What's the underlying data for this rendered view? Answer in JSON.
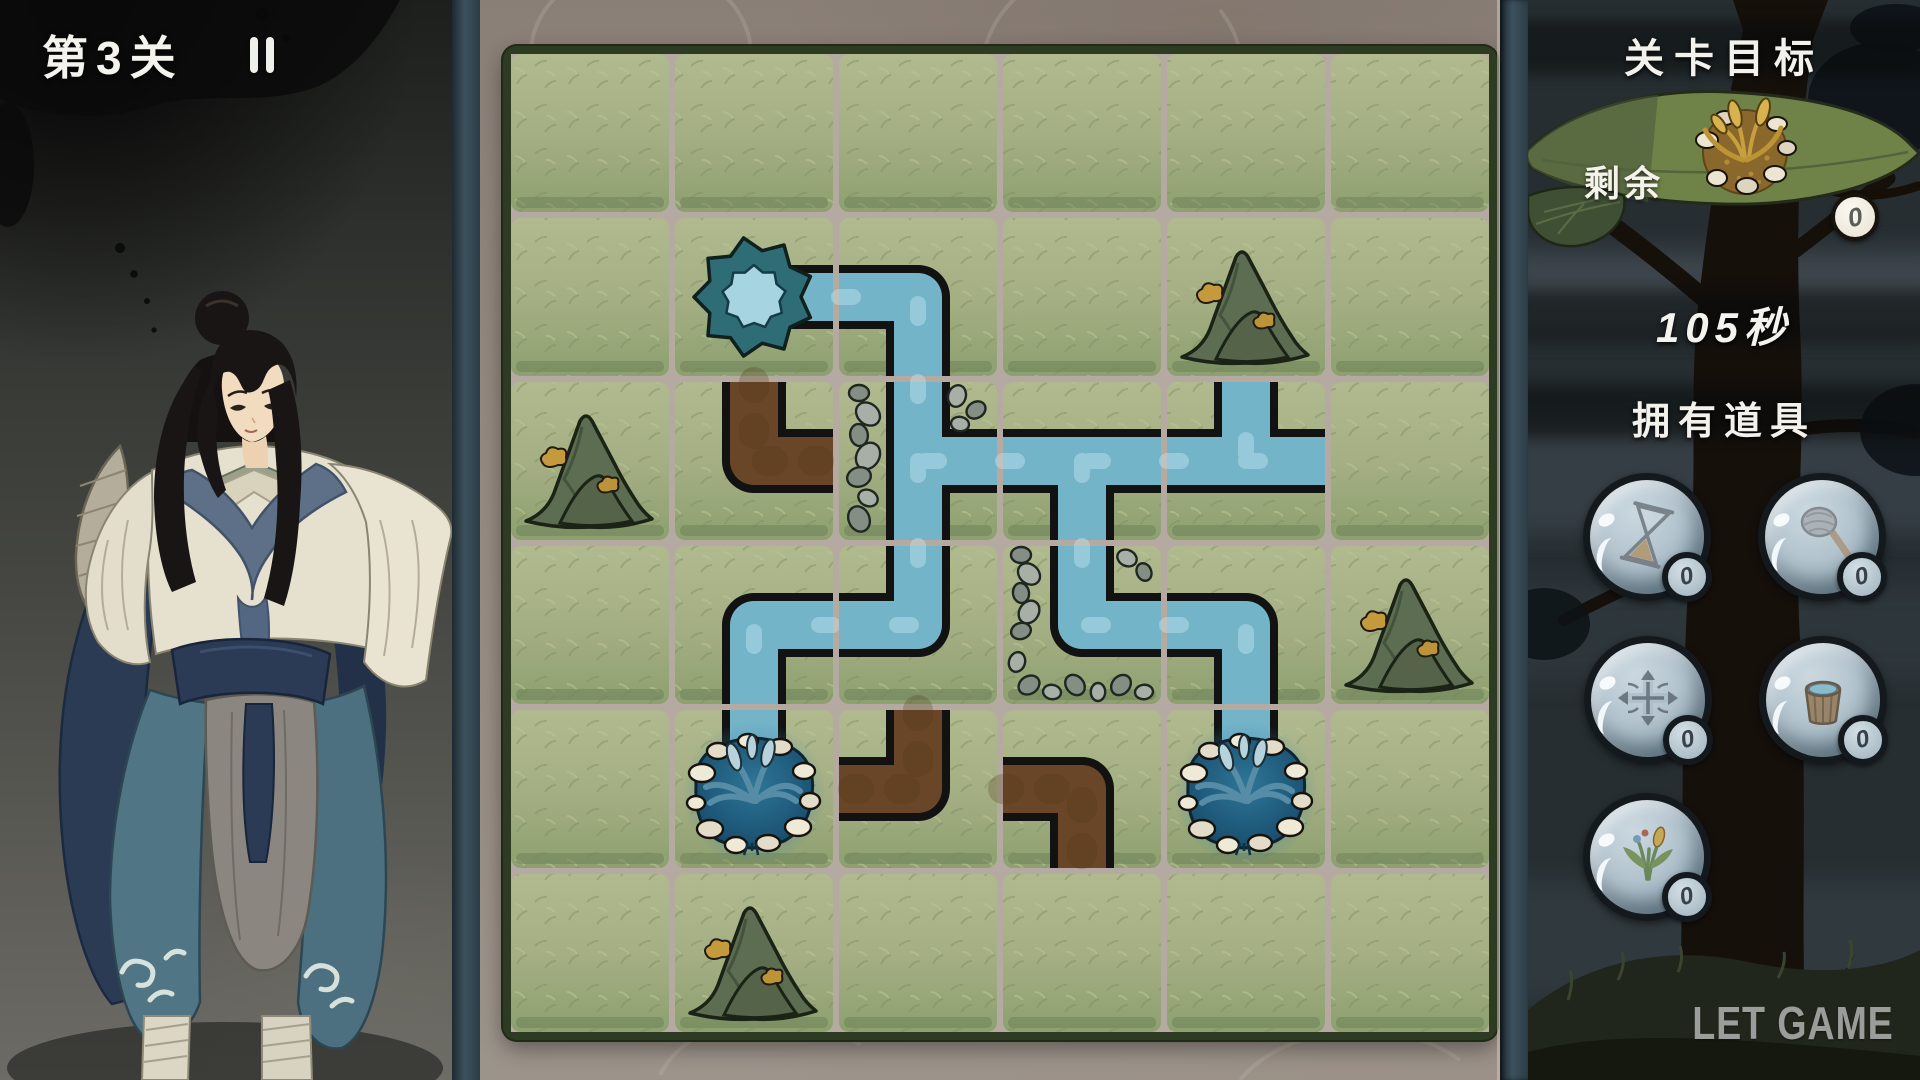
{
  "hud": {
    "level_label": "第3关",
    "pause_icon": "pause-icon"
  },
  "board": {
    "rows": 6,
    "cols": 6,
    "legend": {
      "g": "grass",
      "m": "gold-mountain",
      "spring": "spring-source",
      "pond": "wheat-pond",
      "w": "water-channel",
      "d": "dirt-channel"
    },
    "grid": [
      [
        "g",
        "g",
        "g",
        "g",
        "g",
        "g"
      ],
      [
        "g",
        "spring",
        "w:WS",
        "g",
        "m",
        "g"
      ],
      [
        "m",
        "d:NE",
        "w:NES:rw",
        "w:WES",
        "w:WNE",
        "g"
      ],
      [
        "g",
        "w:ES",
        "w:NW",
        "w:NE:r2",
        "w:WS",
        "m"
      ],
      [
        "g",
        "pond",
        "d:NW",
        "d:WS",
        "pond",
        "g"
      ],
      [
        "g",
        "m",
        "g",
        "g",
        "g",
        "g"
      ]
    ]
  },
  "right_panel": {
    "goal_title": "关卡目标",
    "remaining_label": "剩余",
    "remaining_count": "0",
    "timer": "105秒",
    "items_title": "拥有道具",
    "items": [
      {
        "name": "hourglass",
        "count": "0"
      },
      {
        "name": "mallet",
        "count": "0"
      },
      {
        "name": "direction-arrows",
        "count": "0"
      },
      {
        "name": "water-bucket",
        "count": "0"
      },
      {
        "name": "seedling",
        "count": "0"
      }
    ],
    "watermark": "LET GAME"
  },
  "colors": {
    "water": "#74b4c9",
    "dirt": "#684627",
    "grass": "#a3ae82",
    "board_gap": "#b4aaa1",
    "board_frame": "#2e3b23",
    "stone_bg": "#8f857c",
    "leaf_green": "#6f8349",
    "night_panel": "#262e32",
    "bubble": "#b2c3cd",
    "text_white": "#f2f1ec"
  }
}
